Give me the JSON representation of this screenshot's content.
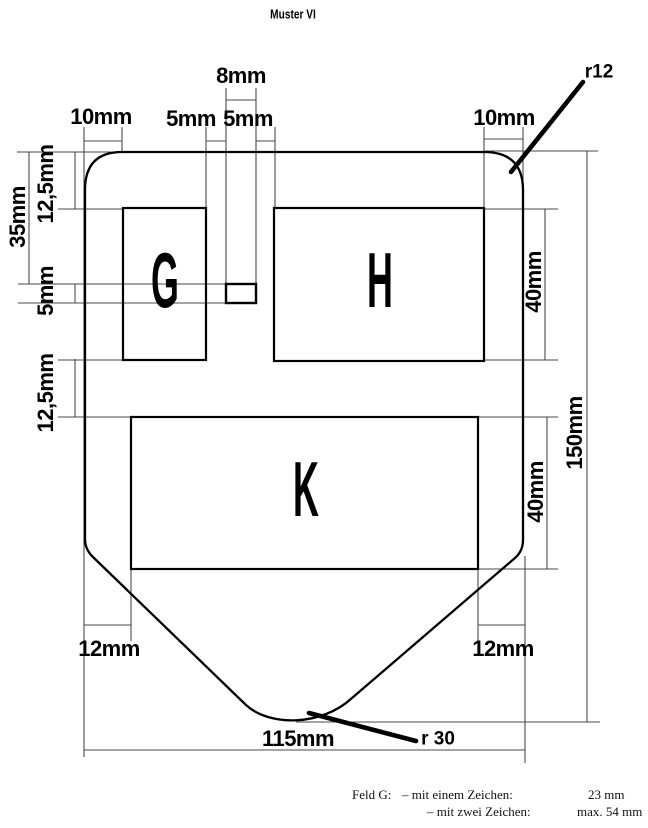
{
  "title": "Muster VI",
  "colors": {
    "outline": "#000000",
    "dimension_line": "#4a4a4a",
    "background": "#ffffff"
  },
  "fields": {
    "g": "G",
    "h": "H",
    "k": "K"
  },
  "dimensions": {
    "top_width_8": "8mm",
    "gap_5_left": "5mm",
    "gap_5_right": "5mm",
    "corner_10_left": "10mm",
    "corner_10_right": "10mm",
    "radius_top": "r12",
    "left_12_5_top": "12,5mm",
    "left_35": "35mm",
    "left_5": "5mm",
    "left_12_5_bottom": "12,5mm",
    "right_40_h": "40mm",
    "right_40_k": "40mm",
    "right_150": "150mm",
    "bottom_12_left": "12mm",
    "bottom_12_right": "12mm",
    "bottom_115": "115mm",
    "radius_bottom": "r 30"
  },
  "footnote": {
    "label": "Feld G:",
    "item1": "– mit einem Zeichen:",
    "value1": "23 mm",
    "item2": "– mit zwei Zeichen:",
    "value2": "max. 54 mm"
  }
}
